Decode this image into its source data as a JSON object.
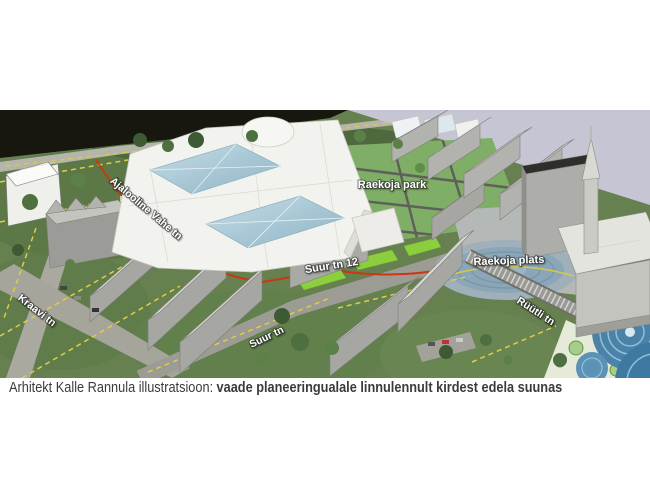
{
  "caption": {
    "prefix": "Arhitekt Kalle Rannula illustratsioon:",
    "emphasis": "vaade planeeringualale linnulennult kirdest edela suunas"
  },
  "labels": {
    "street_ajalooline": "Ajalooline Vahe tn",
    "street_kraavi": "Kraavi tn",
    "building_suur12": "Suur tn 12",
    "street_suur": "Suur tn",
    "park": "Raekoja park",
    "plats": "Raekoja plats",
    "street_ruutli": "Rüütli tn"
  },
  "colors": {
    "viewport_sky": "#c6c5d4",
    "water": "#17170f",
    "park_green": "#7fae66",
    "plaza_blue": "#8fa9ba",
    "fountain_blue": "#4b82a8",
    "new_buildings_white": "#f2f2ee",
    "existing_buildings_gray": "#a6a6a2",
    "cadastral_yellow": "#e0cd45",
    "route_red": "#c93812",
    "label_text": "#ffffff",
    "caption_text": "#3b3b3b"
  }
}
